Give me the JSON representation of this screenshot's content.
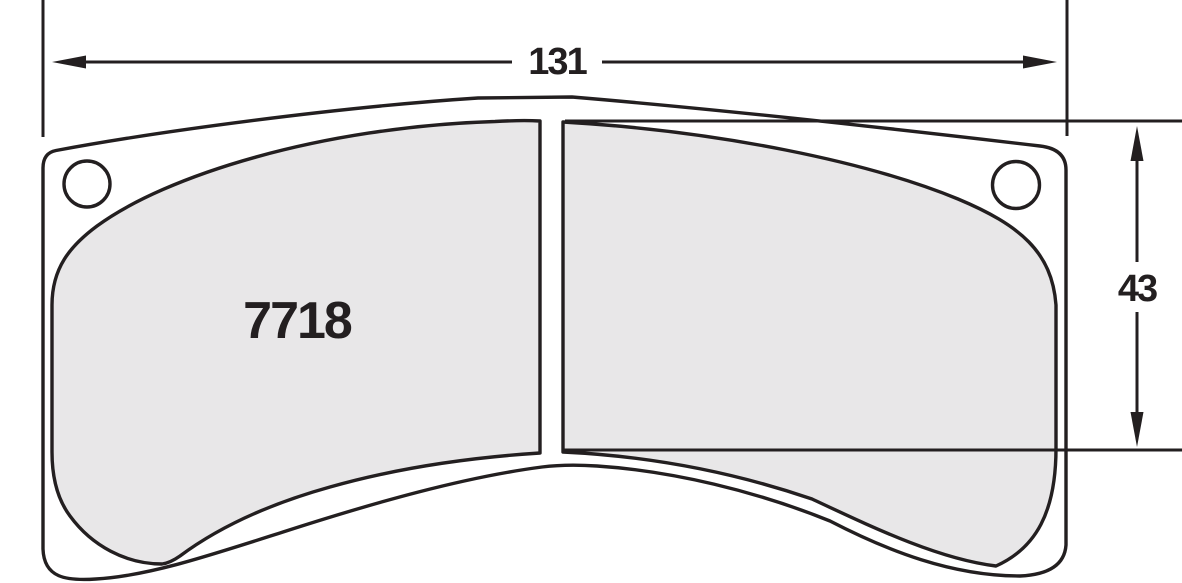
{
  "diagram": {
    "part_number": "7718",
    "width_dimension": {
      "label": "131"
    },
    "height_dimension": {
      "label": "43"
    },
    "colors": {
      "line": "#231f20",
      "friction_fill": "#e8e7e8",
      "plate_fill": "#ffffff"
    }
  }
}
